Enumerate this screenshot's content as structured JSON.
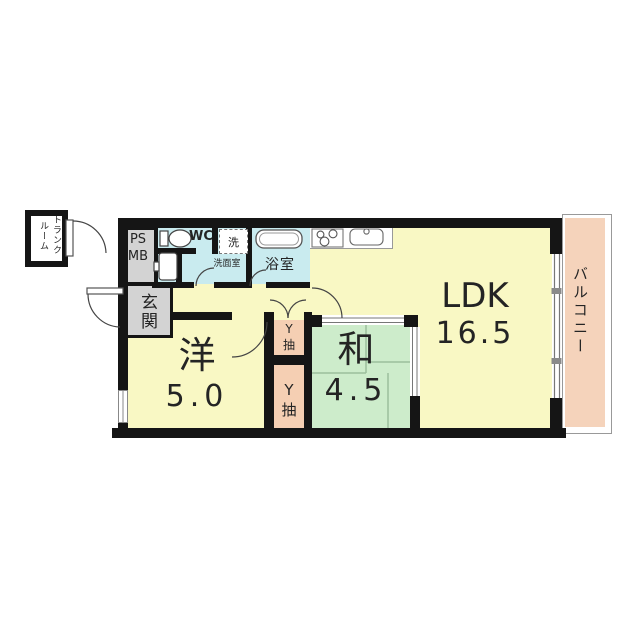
{
  "plan": {
    "type": "apartment-floor-plan",
    "rooms": {
      "ldk": {
        "label": "LDK",
        "size": "16.5"
      },
      "japanese": {
        "label": "和",
        "size": "4.5"
      },
      "western": {
        "label": "洋",
        "size": "5.0"
      },
      "entrance": {
        "label": "玄関"
      },
      "bathroom": {
        "label": "浴室"
      },
      "washroom": {
        "label": "洗面室"
      },
      "wc": {
        "label": "WC"
      },
      "laundry": {
        "label": "洗"
      },
      "pipe_space": {
        "label_top": "PS",
        "label_bottom": "MB"
      },
      "balcony": {
        "label": "バルコニー"
      },
      "trunk_room": {
        "label_col_right": "トランク",
        "label_col_left": "ルーム"
      },
      "closet_upper": {
        "char1": "Y",
        "char2": "抽"
      },
      "closet_lower": {
        "char1": "Y",
        "char2": "抽"
      }
    },
    "colors": {
      "room_yellow": "#f9f8c4",
      "tatami_green": "#cdeccb",
      "closet_salmon": "#f5cfb3",
      "wet_area_cyan": "#c9ebef",
      "utility_gray": "#d3d3d3",
      "balcony_fill": "#f5d3bb",
      "wall_black": "#151515",
      "tatami_line": "#9cbf9c"
    },
    "fixtures": [
      "toilet-icon",
      "washbasin-icon",
      "bathtub-icon",
      "stove-icon",
      "kitchen-sink-icon"
    ]
  }
}
